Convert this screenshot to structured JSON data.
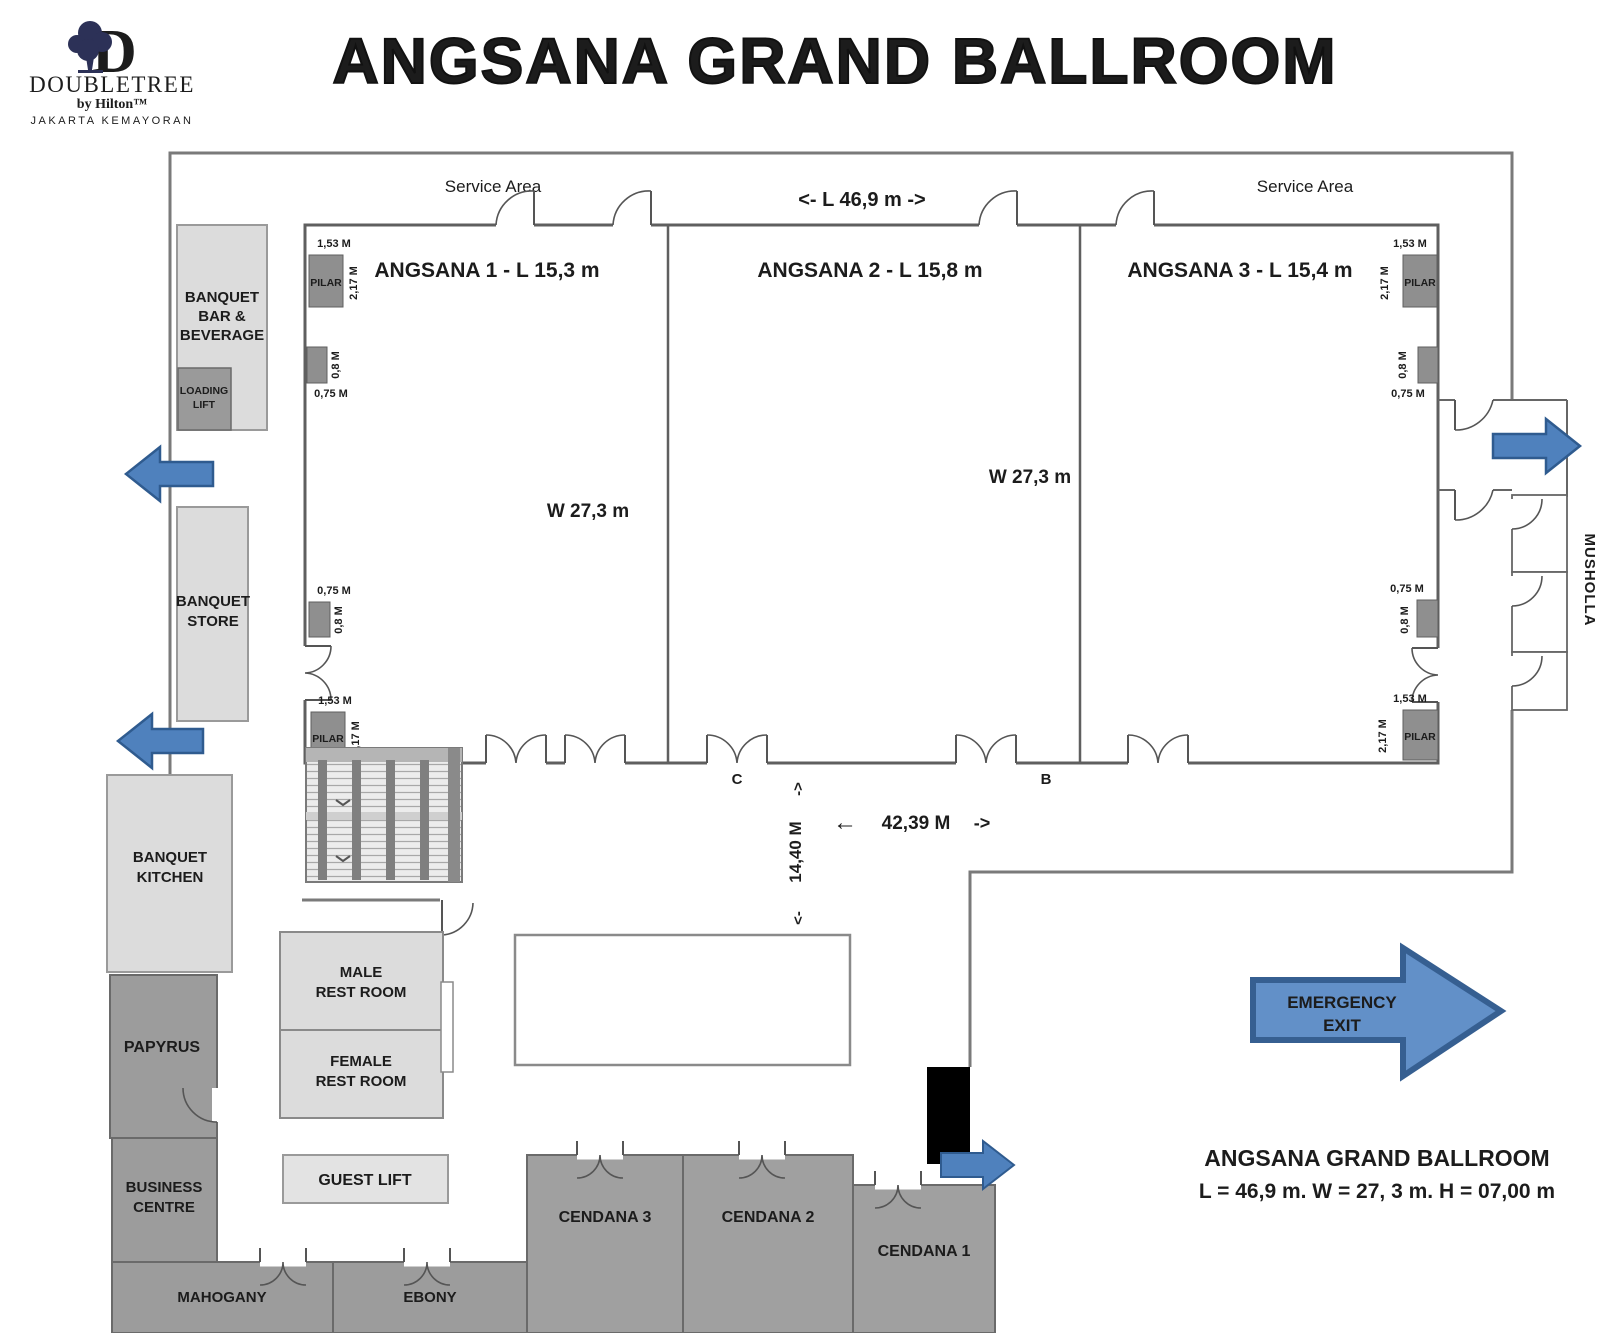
{
  "logo": {
    "mark": "D",
    "brand": "DOUBLETREE",
    "byline": "by Hilton™",
    "location": "JAKARTA KEMAYORAN"
  },
  "title": "ANGSANA GRAND BALLROOM",
  "labels": {
    "service_area_left": "Service Area",
    "service_area_right": "Service Area",
    "top_length": "<- L  46,9 m ->",
    "hall1": "ANGSANA 1 - L  15,3 m",
    "hall2": "ANGSANA 2 - L  15,8 m",
    "hall3": "ANGSANA 3 - L  15,4 m",
    "width1": "W 27,3 m",
    "width2": "W 27,3 m",
    "pilar": "PILAR",
    "d153": "1,53 M",
    "d217": "2,17 M",
    "d08": "0,8 M",
    "d075": "0,75 M",
    "door_c": "C",
    "door_b": "B",
    "dim_h_arrow_left": "←",
    "dim_h": "42,39 M",
    "dim_h_arrow_right": "->",
    "dim_v": "14,40 M",
    "dim_v_arrow_top": "->",
    "dim_v_arrow_bottom": "<-",
    "musholla": "MUSHOLLA"
  },
  "rooms": {
    "banquet_bar_l1": "BANQUET",
    "banquet_bar_l2": "BAR &",
    "banquet_bar_l3": "BEVERAGE",
    "loading_lift_l1": "LOADING",
    "loading_lift_l2": "LIFT",
    "banquet_store_l1": "BANQUET",
    "banquet_store_l2": "STORE",
    "banquet_kitchen_l1": "BANQUET",
    "banquet_kitchen_l2": "KITCHEN",
    "papyrus": "PAPYRUS",
    "business_centre_l1": "BUSINESS",
    "business_centre_l2": "CENTRE",
    "mahogany": "MAHOGANY",
    "ebony": "EBONY",
    "male_restroom_l1": "MALE",
    "male_restroom_l2": "REST ROOM",
    "female_restroom_l1": "FEMALE",
    "female_restroom_l2": "REST ROOM",
    "guest_lift": "GUEST LIFT",
    "cendana3": "CENDANA 3",
    "cendana2": "CENDANA 2",
    "cendana1": "CENDANA 1"
  },
  "emergency": {
    "l1": "EMERGENCY",
    "l2": "EXIT"
  },
  "caption": {
    "l1": "ANGSANA GRAND BALLROOM",
    "l2": "L = 46,9 m.  W = 27, 3 m.   H = 07,00 m"
  },
  "colors": {
    "navy": "#2c3157",
    "wall_gray": "#7a7a7a",
    "light_room": "#dcdcdc",
    "dark_room": "#9c9c9c",
    "pillar_gray": "#8f8f8f",
    "arrow_blue": "#4f81bd",
    "arrow_border": "#2f5b8f",
    "emergency_fill": "#6290c8",
    "emergency_border": "#365f91"
  }
}
